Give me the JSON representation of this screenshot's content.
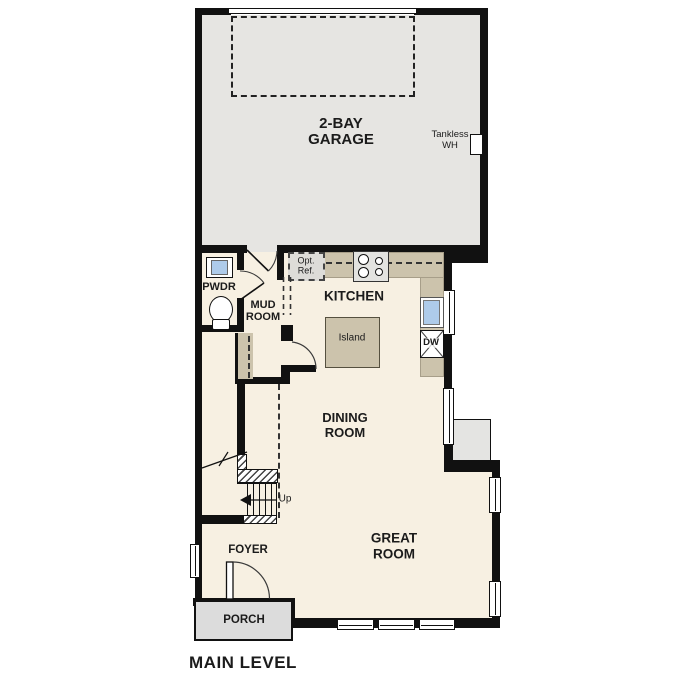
{
  "plan": {
    "title": "MAIN LEVEL",
    "rooms": {
      "garage": {
        "label": "2-BAY\nGARAGE"
      },
      "powder": {
        "label": "PWDR"
      },
      "mud": {
        "label": "MUD\nROOM"
      },
      "kitchen": {
        "label": "KITCHEN"
      },
      "dining": {
        "label": "DINING\nROOM"
      },
      "great": {
        "label": "GREAT\nROOM"
      },
      "foyer": {
        "label": "FOYER"
      },
      "porch": {
        "label": "PORCH"
      }
    },
    "annotations": {
      "tankless_wh": "Tankless\nWH",
      "opt_ref": "Opt.\nRef.",
      "island": "Island",
      "dishwasher": "DW",
      "stairs_up": "Up"
    },
    "colors": {
      "wall": "#111111",
      "floor": "#f7f0e2",
      "garage_floor": "#e6e5e2",
      "counter": "#ccc3ac",
      "porch": "#dcdcdc",
      "sink": "#aecbea",
      "exterior_box": "#e4e4e2"
    }
  }
}
